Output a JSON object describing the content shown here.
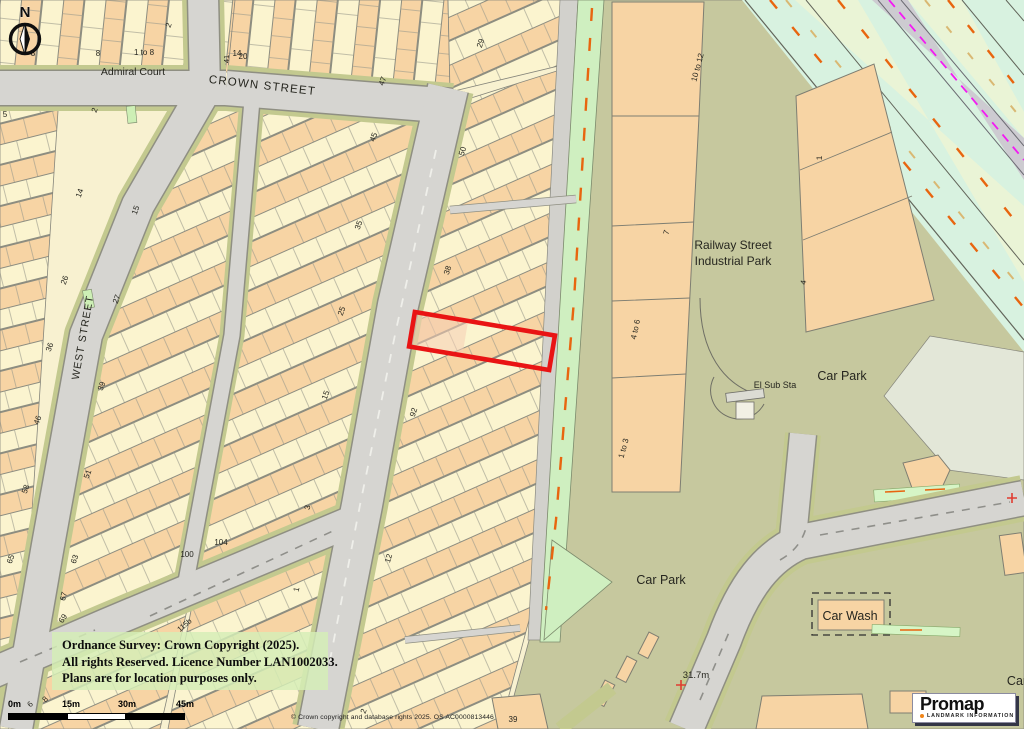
{
  "map": {
    "labels": [
      {
        "t": "Admiral Court",
        "x": 133,
        "y": 75,
        "s": 10.5,
        "r": 0
      },
      {
        "t": "CROWN STREET",
        "x": 262,
        "y": 89,
        "s": 11.5,
        "r": 6.5,
        "sp": 1.2
      },
      {
        "t": "WEST STREET",
        "x": 86,
        "y": 338,
        "s": 10.5,
        "r": -80,
        "sp": 1
      },
      {
        "t": "Railway Street",
        "x": 733,
        "y": 249,
        "s": 12,
        "r": 0
      },
      {
        "t": "Industrial Park",
        "x": 733,
        "y": 265,
        "s": 12,
        "r": 0
      },
      {
        "t": "Car Park",
        "x": 842,
        "y": 380,
        "s": 12.5,
        "r": 0
      },
      {
        "t": "El Sub Sta",
        "x": 775,
        "y": 388,
        "s": 9,
        "r": 0
      },
      {
        "t": "Car Park",
        "x": 661,
        "y": 584,
        "s": 12.5,
        "r": 0
      },
      {
        "t": "Car Wash",
        "x": 850,
        "y": 620,
        "s": 12.5,
        "r": 0
      },
      {
        "t": "Car",
        "x": 1017,
        "y": 685,
        "s": 12.5,
        "r": 0
      },
      {
        "t": "31.7m",
        "x": 696,
        "y": 678,
        "s": 9.5,
        "r": 0
      },
      {
        "t": "8",
        "x": 33,
        "y": 56,
        "s": 8,
        "r": 0
      },
      {
        "t": "8",
        "x": 98,
        "y": 56,
        "s": 8,
        "r": 0
      },
      {
        "t": "14",
        "x": 237,
        "y": 56,
        "s": 8,
        "r": 0
      },
      {
        "t": "1 to 8",
        "x": 144,
        "y": 55,
        "s": 8,
        "r": 0
      },
      {
        "t": "2",
        "x": 171,
        "y": 26,
        "s": 8,
        "r": -70
      },
      {
        "t": "41",
        "x": 229,
        "y": 59,
        "s": 7.5,
        "r": -90
      },
      {
        "t": "20",
        "x": 243,
        "y": 59,
        "s": 8,
        "r": 0
      },
      {
        "t": "5",
        "x": 5,
        "y": 117,
        "s": 8,
        "r": 0
      },
      {
        "t": "2",
        "x": 97,
        "y": 111,
        "s": 8,
        "r": -70
      },
      {
        "t": "14",
        "x": 82,
        "y": 194,
        "s": 8,
        "r": -70
      },
      {
        "t": "15",
        "x": 138,
        "y": 211,
        "s": 8,
        "r": -70
      },
      {
        "t": "26",
        "x": 67,
        "y": 281,
        "s": 8,
        "r": -70
      },
      {
        "t": "27",
        "x": 119,
        "y": 300,
        "s": 8,
        "r": -70
      },
      {
        "t": "36",
        "x": 52,
        "y": 348,
        "s": 8,
        "r": -70
      },
      {
        "t": "39",
        "x": 104,
        "y": 387,
        "s": 8,
        "r": -70
      },
      {
        "t": "46",
        "x": 40,
        "y": 421,
        "s": 8,
        "r": -70
      },
      {
        "t": "15",
        "x": 328,
        "y": 396,
        "s": 8,
        "r": -70
      },
      {
        "t": "58",
        "x": 28,
        "y": 490,
        "s": 8,
        "r": -70
      },
      {
        "t": "51",
        "x": 90,
        "y": 475,
        "s": 8,
        "r": -70
      },
      {
        "t": "65",
        "x": 13,
        "y": 560,
        "s": 8,
        "r": -70
      },
      {
        "t": "63",
        "x": 77,
        "y": 560,
        "s": 8,
        "r": -70
      },
      {
        "t": "67",
        "x": 66,
        "y": 597,
        "s": 8,
        "r": -75
      },
      {
        "t": "69",
        "x": 65,
        "y": 620,
        "s": 8,
        "r": -55
      },
      {
        "t": "100",
        "x": 187,
        "y": 557,
        "s": 8,
        "r": 0
      },
      {
        "t": "104",
        "x": 221,
        "y": 545,
        "s": 8,
        "r": 0
      },
      {
        "t": "115b",
        "x": 186,
        "y": 627,
        "s": 7.5,
        "r": -40
      },
      {
        "t": "6",
        "x": 32,
        "y": 706,
        "s": 8,
        "r": -45
      },
      {
        "t": "8",
        "x": 47,
        "y": 701,
        "s": 8,
        "r": -45
      },
      {
        "t": "29",
        "x": 483,
        "y": 44,
        "s": 8,
        "r": -72
      },
      {
        "t": "47",
        "x": 385,
        "y": 82,
        "s": 8,
        "r": -70
      },
      {
        "t": "45",
        "x": 376,
        "y": 138,
        "s": 8,
        "r": -70
      },
      {
        "t": "50",
        "x": 465,
        "y": 152,
        "s": 8,
        "r": -72
      },
      {
        "t": "35",
        "x": 361,
        "y": 226,
        "s": 8,
        "r": -70
      },
      {
        "t": "25",
        "x": 344,
        "y": 312,
        "s": 8,
        "r": -70
      },
      {
        "t": "38",
        "x": 450,
        "y": 271,
        "s": 8,
        "r": -72
      },
      {
        "t": "92",
        "x": 416,
        "y": 413,
        "s": 8,
        "r": -72
      },
      {
        "t": "12",
        "x": 391,
        "y": 559,
        "s": 8,
        "r": -74
      },
      {
        "t": "2",
        "x": 366,
        "y": 712,
        "s": 8,
        "r": -70
      },
      {
        "t": "39",
        "x": 513,
        "y": 722,
        "s": 8,
        "r": 0
      },
      {
        "t": "3",
        "x": 310,
        "y": 508,
        "s": 8,
        "r": -78
      },
      {
        "t": "1",
        "x": 299,
        "y": 590,
        "s": 8,
        "r": -78
      },
      {
        "t": "10 to 12",
        "x": 700,
        "y": 68,
        "s": 8,
        "r": -75
      },
      {
        "t": "7",
        "x": 669,
        "y": 233,
        "s": 8,
        "r": -75
      },
      {
        "t": "4 to 6",
        "x": 638,
        "y": 330,
        "s": 8,
        "r": -78
      },
      {
        "t": "1 to 3",
        "x": 626,
        "y": 449,
        "s": 8,
        "r": -75
      },
      {
        "t": "1",
        "x": 822,
        "y": 158,
        "s": 8,
        "r": -88
      },
      {
        "t": "4",
        "x": 806,
        "y": 283,
        "s": 8,
        "r": -78
      }
    ],
    "crosses": [
      {
        "x": 681,
        "y": 685
      },
      {
        "x": 1012,
        "y": 498
      }
    ],
    "plot_outline_color": "#E91414"
  },
  "compass": {
    "label": "N"
  },
  "copyright_box": {
    "line1": "Ordnance Survey: Crown Copyright (2025).",
    "line2": "All rights Reserved.  Licence Number LAN1002033.",
    "line3": "Plans are for location purposes only."
  },
  "scale_bar": {
    "labels": [
      "0m",
      "15m",
      "30m",
      "45m"
    ]
  },
  "attribution": {
    "text": "© Crown copyright and database rights 2025. OS AC0000813446"
  },
  "logo": {
    "name": "Promap",
    "tagline": "LANDMARK INFORMATION"
  },
  "colors": {
    "base": "#F8F1D0",
    "cream": "#FBF4CF",
    "peach": "#F7D4A4",
    "olive": "#C6C89E",
    "sage": "#E3E7D8",
    "mint": "#D8F2E0",
    "pale_green": "#EAF4D6",
    "rail_gray": "#CDCBD1",
    "road": "#D6D5D1",
    "verge": "#C3C98F",
    "footpath": "#CFEFC0",
    "parking_strip": "#D6F5C6",
    "outline": "#85857B",
    "plot_red": "#E91414",
    "orange_dash": "#E8650F",
    "tan_dash": "#D9B873",
    "magenta_dash": "#F319F3",
    "cross_red": "#E03C31",
    "logo_orange": "#F08519"
  }
}
